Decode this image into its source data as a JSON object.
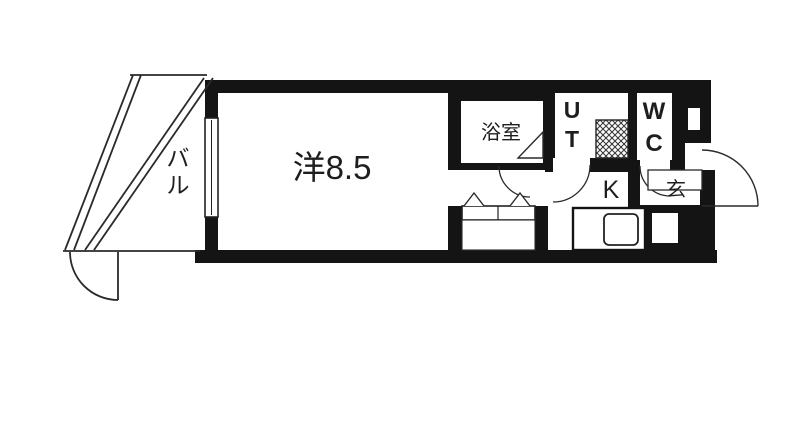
{
  "title": "apartment-floor-plan",
  "colors": {
    "wall": "#141414",
    "line": "#2a2a2a",
    "floor": "#ffffff",
    "background": "#ffffff"
  },
  "rooms": {
    "balcony": {
      "label": "バル",
      "chars": [
        "バ",
        "ル"
      ]
    },
    "main": {
      "label": "洋8.5"
    },
    "bath": {
      "label": "浴室"
    },
    "utility": {
      "label": "UT",
      "chars": [
        "U",
        "T"
      ]
    },
    "wc": {
      "label": "WC",
      "chars": [
        "W",
        "C"
      ]
    },
    "kitchen": {
      "label": "K"
    },
    "entrance": {
      "label": "玄"
    }
  }
}
